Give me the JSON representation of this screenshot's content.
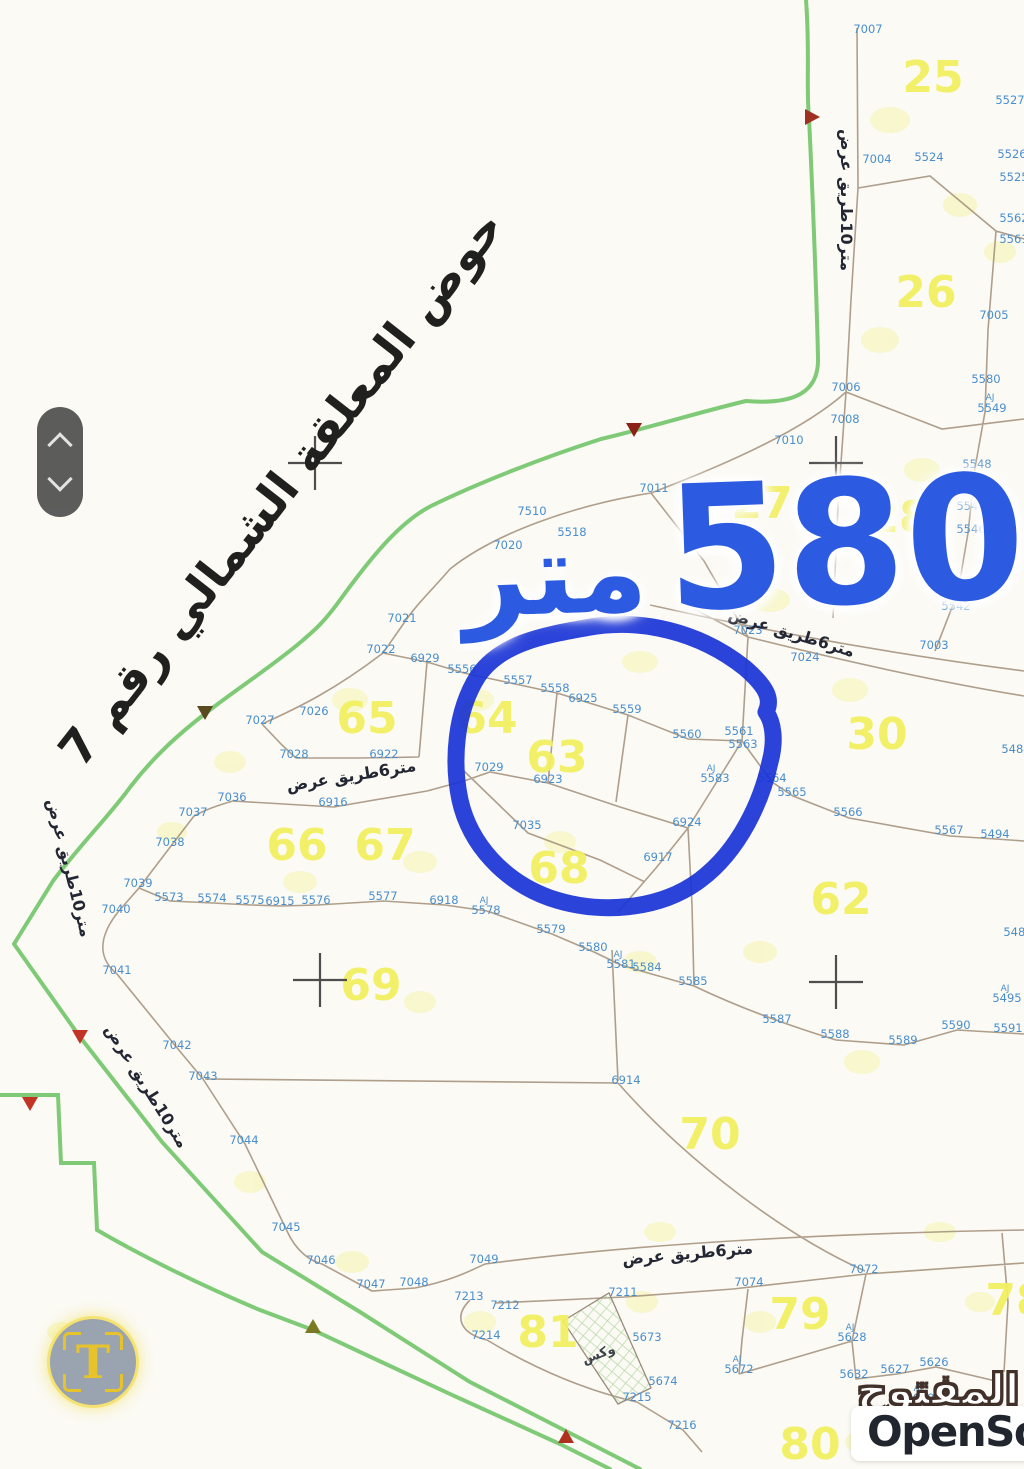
{
  "map": {
    "title": "حوض المعلقة الشمالي رقم 7",
    "measure_value": "580",
    "measure_unit": "متر",
    "colors": {
      "circle": "#1b35d6",
      "measure_text": "#2c5ae0",
      "parcel_number": "#f2f05e",
      "plot_number": "#4a8ecd",
      "road_line": "#7fca77",
      "boundary_line": "#a6937f"
    },
    "parcel_numbers": [
      {
        "n": "25",
        "x": 933,
        "y": 92
      },
      {
        "n": "26",
        "x": 926,
        "y": 307
      },
      {
        "n": "27",
        "x": 762,
        "y": 518
      },
      {
        "n": "28",
        "x": 899,
        "y": 532
      },
      {
        "n": "30",
        "x": 877,
        "y": 749
      },
      {
        "n": "62",
        "x": 841,
        "y": 914
      },
      {
        "n": "63",
        "x": 557,
        "y": 772
      },
      {
        "n": "64",
        "x": 487,
        "y": 733
      },
      {
        "n": "65",
        "x": 367,
        "y": 733
      },
      {
        "n": "66",
        "x": 297,
        "y": 860
      },
      {
        "n": "67",
        "x": 385,
        "y": 860
      },
      {
        "n": "68",
        "x": 559,
        "y": 883
      },
      {
        "n": "69",
        "x": 371,
        "y": 1000
      },
      {
        "n": "70",
        "x": 710,
        "y": 1149
      },
      {
        "n": "78",
        "x": 1016,
        "y": 1315
      },
      {
        "n": "79",
        "x": 800,
        "y": 1329
      },
      {
        "n": "80",
        "x": 810,
        "y": 1459
      },
      {
        "n": "81",
        "x": 548,
        "y": 1347
      }
    ],
    "plot_numbers": [
      {
        "n": "7007",
        "x": 868,
        "y": 33
      },
      {
        "n": "5527",
        "x": 1010,
        "y": 104
      },
      {
        "n": "7004",
        "x": 877,
        "y": 163
      },
      {
        "n": "5524",
        "x": 929,
        "y": 161
      },
      {
        "n": "5526",
        "x": 1012,
        "y": 158
      },
      {
        "n": "5525",
        "x": 1014,
        "y": 181
      },
      {
        "n": "5562",
        "x": 1014,
        "y": 222
      },
      {
        "n": "5561",
        "x": 1014,
        "y": 243
      },
      {
        "n": "7005",
        "x": 994,
        "y": 319
      },
      {
        "n": "5580",
        "x": 986,
        "y": 383
      },
      {
        "n": "AJ",
        "x": 990,
        "y": 400,
        "s": 1
      },
      {
        "n": "5549",
        "x": 992,
        "y": 412
      },
      {
        "n": "7006",
        "x": 846,
        "y": 391
      },
      {
        "n": "7008",
        "x": 845,
        "y": 423
      },
      {
        "n": "5548",
        "x": 977,
        "y": 468
      },
      {
        "n": "5547",
        "x": 971,
        "y": 510
      },
      {
        "n": "5546",
        "x": 971,
        "y": 533
      },
      {
        "n": "5545",
        "x": 959,
        "y": 588
      },
      {
        "n": "5542",
        "x": 956,
        "y": 610
      },
      {
        "n": "7010",
        "x": 789,
        "y": 444
      },
      {
        "n": "7011",
        "x": 654,
        "y": 492
      },
      {
        "n": "7510",
        "x": 532,
        "y": 515
      },
      {
        "n": "5518",
        "x": 572,
        "y": 536
      },
      {
        "n": "7020",
        "x": 508,
        "y": 549
      },
      {
        "n": "7021",
        "x": 402,
        "y": 622
      },
      {
        "n": "7023",
        "x": 748,
        "y": 634
      },
      {
        "n": "7024",
        "x": 805,
        "y": 661
      },
      {
        "n": "7003",
        "x": 934,
        "y": 649
      },
      {
        "n": "7022",
        "x": 381,
        "y": 653
      },
      {
        "n": "6929",
        "x": 425,
        "y": 662
      },
      {
        "n": "5556",
        "x": 462,
        "y": 673
      },
      {
        "n": "5557",
        "x": 518,
        "y": 684
      },
      {
        "n": "5558",
        "x": 555,
        "y": 692
      },
      {
        "n": "6925",
        "x": 583,
        "y": 702
      },
      {
        "n": "5559",
        "x": 627,
        "y": 713
      },
      {
        "n": "5560",
        "x": 687,
        "y": 738
      },
      {
        "n": "5561",
        "x": 739,
        "y": 735
      },
      {
        "n": "5563",
        "x": 743,
        "y": 748
      },
      {
        "n": "7026",
        "x": 314,
        "y": 715
      },
      {
        "n": "7027",
        "x": 260,
        "y": 724
      },
      {
        "n": "7028",
        "x": 294,
        "y": 758
      },
      {
        "n": "6922",
        "x": 384,
        "y": 758
      },
      {
        "n": "7029",
        "x": 489,
        "y": 771
      },
      {
        "n": "6923",
        "x": 548,
        "y": 783
      },
      {
        "n": "AJ",
        "x": 711,
        "y": 771,
        "s": 1
      },
      {
        "n": "5583",
        "x": 715,
        "y": 782
      },
      {
        "n": "5564",
        "x": 772,
        "y": 782
      },
      {
        "n": "5565",
        "x": 792,
        "y": 796
      },
      {
        "n": "5566",
        "x": 848,
        "y": 816
      },
      {
        "n": "5567",
        "x": 949,
        "y": 834
      },
      {
        "n": "5494",
        "x": 995,
        "y": 838
      },
      {
        "n": "5484",
        "x": 1016,
        "y": 753
      },
      {
        "n": "7035",
        "x": 527,
        "y": 829
      },
      {
        "n": "6924",
        "x": 687,
        "y": 826
      },
      {
        "n": "6917",
        "x": 658,
        "y": 861
      },
      {
        "n": "7036",
        "x": 232,
        "y": 801
      },
      {
        "n": "6916",
        "x": 333,
        "y": 806
      },
      {
        "n": "7037",
        "x": 193,
        "y": 816
      },
      {
        "n": "7038",
        "x": 170,
        "y": 846
      },
      {
        "n": "7039",
        "x": 138,
        "y": 887
      },
      {
        "n": "5573",
        "x": 169,
        "y": 901
      },
      {
        "n": "5574",
        "x": 212,
        "y": 902
      },
      {
        "n": "5575",
        "x": 250,
        "y": 904
      },
      {
        "n": "6915",
        "x": 280,
        "y": 905
      },
      {
        "n": "5576",
        "x": 316,
        "y": 904
      },
      {
        "n": "5577",
        "x": 383,
        "y": 900
      },
      {
        "n": "6918",
        "x": 444,
        "y": 904
      },
      {
        "n": "AJ",
        "x": 484,
        "y": 903,
        "s": 1
      },
      {
        "n": "5578",
        "x": 486,
        "y": 914
      },
      {
        "n": "5579",
        "x": 551,
        "y": 933
      },
      {
        "n": "5580",
        "x": 593,
        "y": 951
      },
      {
        "n": "AJ",
        "x": 618,
        "y": 957,
        "s": 1
      },
      {
        "n": "5581",
        "x": 621,
        "y": 968
      },
      {
        "n": "5584",
        "x": 647,
        "y": 971
      },
      {
        "n": "5585",
        "x": 693,
        "y": 985
      },
      {
        "n": "7040",
        "x": 116,
        "y": 913
      },
      {
        "n": "7041",
        "x": 117,
        "y": 974
      },
      {
        "n": "7042",
        "x": 177,
        "y": 1049
      },
      {
        "n": "7043",
        "x": 203,
        "y": 1080
      },
      {
        "n": "5587",
        "x": 777,
        "y": 1023
      },
      {
        "n": "5588",
        "x": 835,
        "y": 1038
      },
      {
        "n": "5589",
        "x": 903,
        "y": 1044
      },
      {
        "n": "5590",
        "x": 956,
        "y": 1029
      },
      {
        "n": "5591",
        "x": 1008,
        "y": 1032
      },
      {
        "n": "5485",
        "x": 1018,
        "y": 936
      },
      {
        "n": "AJ",
        "x": 1005,
        "y": 991,
        "s": 1
      },
      {
        "n": "5495",
        "x": 1007,
        "y": 1002
      },
      {
        "n": "6914",
        "x": 626,
        "y": 1084
      },
      {
        "n": "7044",
        "x": 244,
        "y": 1144
      },
      {
        "n": "7045",
        "x": 286,
        "y": 1231
      },
      {
        "n": "7046",
        "x": 321,
        "y": 1264
      },
      {
        "n": "7047",
        "x": 371,
        "y": 1288
      },
      {
        "n": "7048",
        "x": 414,
        "y": 1286
      },
      {
        "n": "7049",
        "x": 484,
        "y": 1263
      },
      {
        "n": "7213",
        "x": 469,
        "y": 1300
      },
      {
        "n": "7212",
        "x": 505,
        "y": 1309
      },
      {
        "n": "7211",
        "x": 623,
        "y": 1296
      },
      {
        "n": "7214",
        "x": 486,
        "y": 1339
      },
      {
        "n": "5673",
        "x": 647,
        "y": 1341
      },
      {
        "n": "5674",
        "x": 663,
        "y": 1385
      },
      {
        "n": "7215",
        "x": 637,
        "y": 1401
      },
      {
        "n": "7216",
        "x": 682,
        "y": 1429
      },
      {
        "n": "7074",
        "x": 749,
        "y": 1286
      },
      {
        "n": "7072",
        "x": 864,
        "y": 1273
      },
      {
        "n": "AJ",
        "x": 850,
        "y": 1330,
        "s": 1
      },
      {
        "n": "5628",
        "x": 852,
        "y": 1341
      },
      {
        "n": "5626",
        "x": 934,
        "y": 1366
      },
      {
        "n": "5627",
        "x": 895,
        "y": 1373
      },
      {
        "n": "5632",
        "x": 854,
        "y": 1378
      },
      {
        "n": "AJ",
        "x": 918,
        "y": 1391,
        "s": 1
      },
      {
        "n": "5629",
        "x": 920,
        "y": 1402
      },
      {
        "n": "AJ",
        "x": 737,
        "y": 1362,
        "s": 1
      },
      {
        "n": "5672",
        "x": 739,
        "y": 1373
      }
    ],
    "road_labels": [
      {
        "t": "متر10طريق عرض",
        "x": 841,
        "y": 200,
        "r": 90
      },
      {
        "t": "متر6طريق عرض",
        "x": 790,
        "y": 638,
        "r": 17
      },
      {
        "t": "متر6طريق عرض",
        "x": 352,
        "y": 781,
        "r": -9
      },
      {
        "t": "متر10طريق عرض",
        "x": 64,
        "y": 869,
        "r": 76
      },
      {
        "t": "متر10طريق عرض",
        "x": 142,
        "y": 1089,
        "r": 58
      },
      {
        "t": "متر6طريق عرض",
        "x": 688,
        "y": 1259,
        "r": -5
      }
    ],
    "misc_labels": [
      {
        "t": "وكس",
        "x": 600,
        "y": 1358,
        "r": -20
      }
    ],
    "crosses": [
      {
        "x": 315,
        "y": 463
      },
      {
        "x": 836,
        "y": 463
      },
      {
        "x": 320,
        "y": 980
      },
      {
        "x": 836,
        "y": 982
      }
    ],
    "triangles": [
      {
        "x": 811,
        "y": 117,
        "c": "#a03020",
        "d": "right"
      },
      {
        "x": 634,
        "y": 429,
        "c": "#8b2015",
        "d": "down"
      },
      {
        "x": 205,
        "y": 712,
        "c": "#5a4a20",
        "d": "down"
      },
      {
        "x": 80,
        "y": 1036,
        "c": "#c03525",
        "d": "down"
      },
      {
        "x": 30,
        "y": 1103,
        "c": "#c03525",
        "d": "down"
      },
      {
        "x": 313,
        "y": 1327,
        "c": "#7a7a25",
        "d": "up"
      },
      {
        "x": 566,
        "y": 1437,
        "c": "#b03020",
        "d": "up"
      }
    ]
  },
  "overlay": {
    "text_tool_label": "T"
  },
  "watermark": {
    "arabic": "السوق المفتوح",
    "latin": "OpenSooq"
  }
}
